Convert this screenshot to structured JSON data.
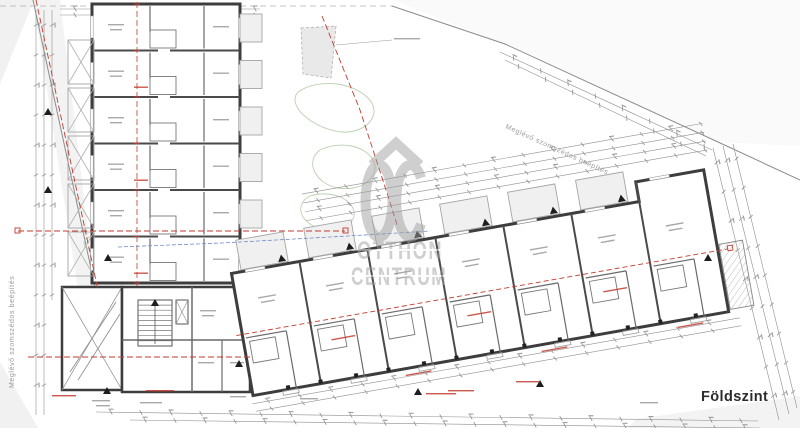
{
  "drawing": {
    "floor_label": "Földszint",
    "watermark": {
      "logo": "OC",
      "line1": "OTTHON",
      "line2": "CENTRUM"
    },
    "boundary_labels": {
      "top_right": "Meglévő szomszédos beépítés",
      "left": "Meglévő szomszédos beépítés"
    },
    "left_wing_units": 6,
    "right_wing_units": 7,
    "left_balcony_bays": 5,
    "colors": {
      "paper": "#ffffff",
      "outer_wall": "#3d3d3d",
      "inner_wall": "#6a6a6a",
      "dimension": "#8f8f8f",
      "annotation_red": "#c23b2f",
      "landscape_green": "#abc49e",
      "utility_blue": "#6e8bc5",
      "watermark_gray": "#a0a0a0",
      "title_text": "#2b2b2b",
      "light_fill": "#f0f0f0"
    }
  }
}
